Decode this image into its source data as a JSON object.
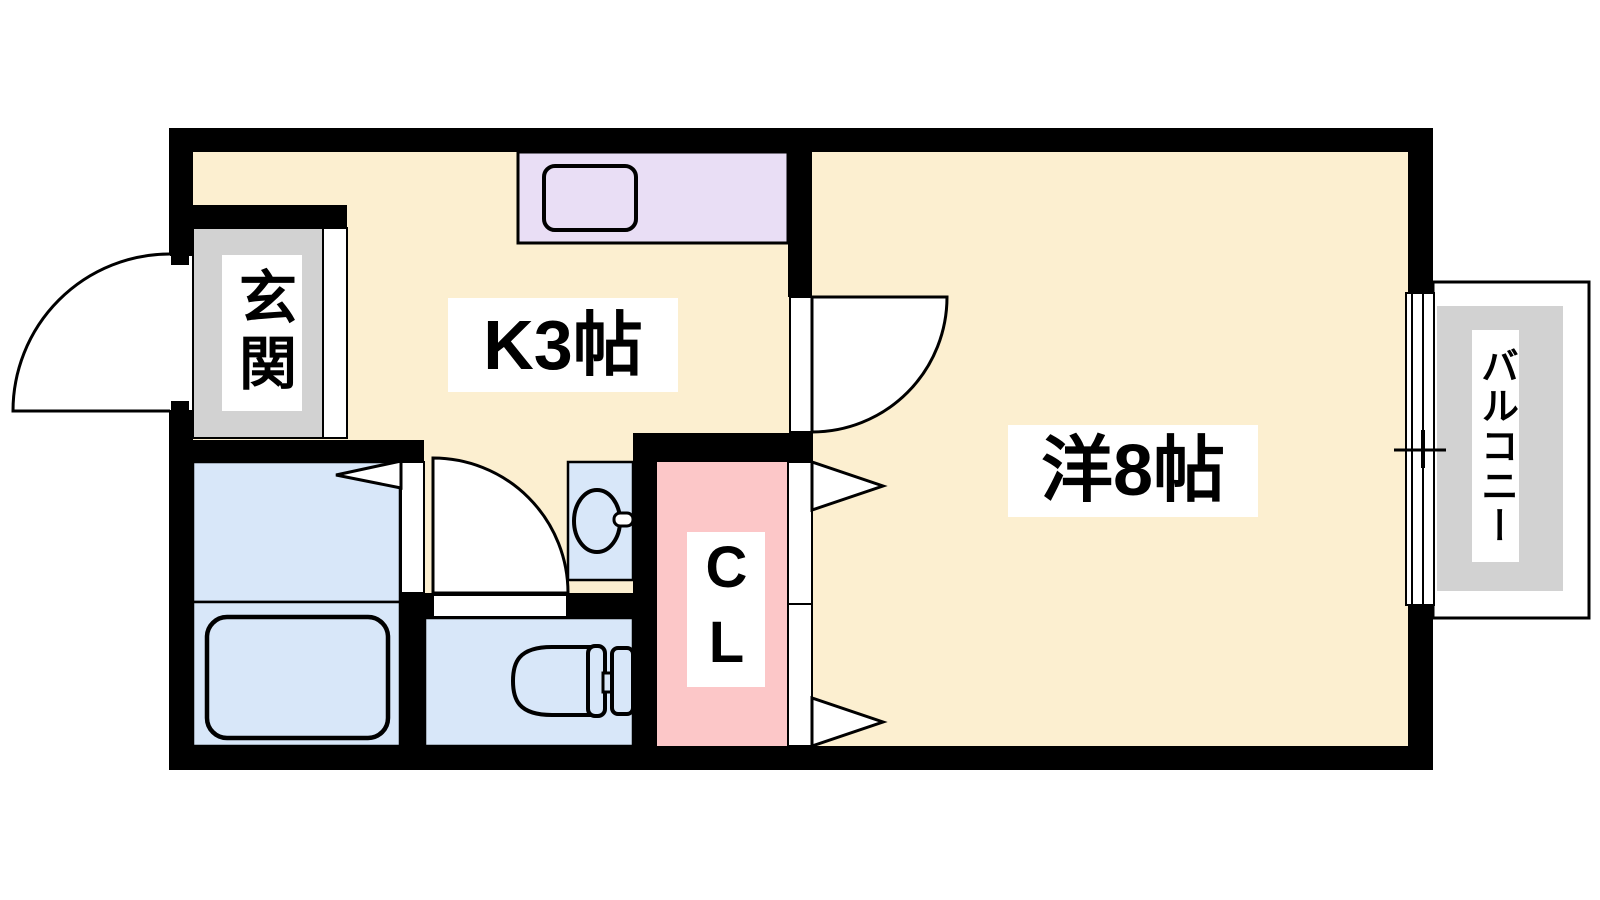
{
  "floorplan": {
    "rooms": {
      "entrance_label": "玄関",
      "kitchen_label": "K3帖",
      "western_room_label": "洋8帖",
      "closet_label": "CL",
      "balcony_label": "バルコニー"
    },
    "colors": {
      "floor": "#fcefd0",
      "counter": "#e9def5",
      "wet_area": "#d8e7f9",
      "closet": "#fcc7c8",
      "entrance": "#d2d2d2",
      "balcony": "#d2d2d2",
      "wall": "#000000",
      "door_fill": "#ffffff",
      "label_bg": "#ffffff"
    }
  }
}
